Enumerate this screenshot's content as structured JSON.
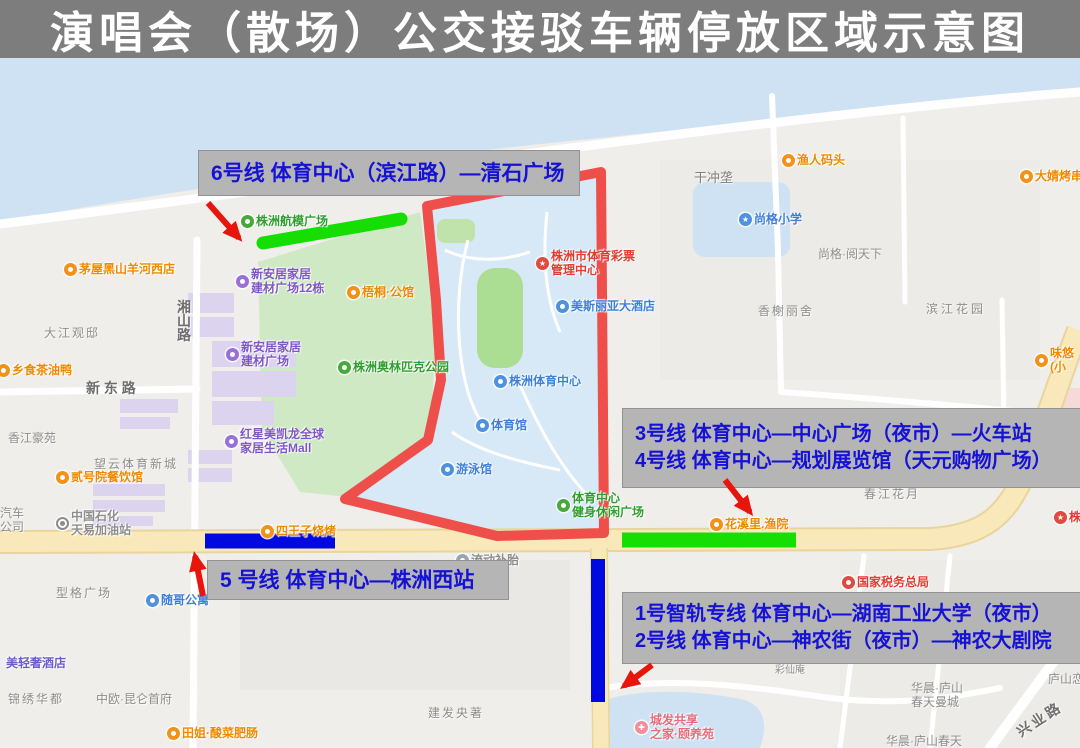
{
  "title": {
    "text": "演唱会（散场）公交接驳车辆停放区域示意图"
  },
  "colors": {
    "title_bg": "#7d7d7d",
    "title_text": "#ffffff",
    "annotation_box": "#b5b5b5",
    "annotation_text": "#1512d6",
    "route_green": "#16dd02",
    "route_blue": "#0009e0",
    "outline_red": "#ee4f4a",
    "arrow_red": "#e8150d"
  },
  "annotations": {
    "line6": {
      "text": "6号线 体育中心（滨江路）—清石广场"
    },
    "line34": {
      "line1": "3号线 体育中心—中心广场（夜市）—火车站",
      "line2": "4号线 体育中心—规划展览馆（天元购物广场）"
    },
    "line5": {
      "text": "5 号线 体育中心—株洲西站"
    },
    "line12": {
      "line1": "1号智轨专线 体育中心—湖南工业大学（夜市）",
      "line2": "2号线 体育中心—神农街（夜市）—神农大剧院"
    }
  },
  "map": {
    "pois": [
      {
        "name": "poi-yuren-wharf",
        "x": 788,
        "y": 160,
        "icon": "food-icon",
        "icon_bg": "#f39119",
        "text_color": "#ef8a00",
        "lines": [
          "渔人码头"
        ]
      },
      {
        "name": "poi-dajing-bbq",
        "x": 1026,
        "y": 176,
        "icon": "food-icon",
        "icon_bg": "#f39119",
        "text_color": "#ef8a00",
        "lines": [
          "大婧烤串"
        ]
      },
      {
        "name": "poi-shangge-school",
        "x": 745,
        "y": 219,
        "icon": "school-icon",
        "icon_bg": "#4e92dd",
        "glyph": "★",
        "text_color": "#3f7fd8",
        "lines": [
          "尚格小学"
        ]
      },
      {
        "name": "poi-weiyou-snack",
        "x": 1041,
        "y": 360,
        "icon": "food-icon",
        "icon_bg": "#f39119",
        "text_color": "#ef8a00",
        "lines": [
          "味悠",
          "(小"
        ]
      },
      {
        "name": "poi-maowu-restaurant",
        "x": 70,
        "y": 269,
        "icon": "food-icon",
        "icon_bg": "#f39119",
        "text_color": "#ef8a00",
        "lines": [
          "茅屋黑山羊河西店"
        ]
      },
      {
        "name": "poi-xiangshi-duck",
        "x": 3,
        "y": 370,
        "icon": "food-icon",
        "icon_bg": "#f39119",
        "text_color": "#ef8a00",
        "lines": [
          "乡食茶油鸭"
        ]
      },
      {
        "name": "poi-hangmo-square",
        "x": 247,
        "y": 221,
        "icon": "park-icon",
        "icon_bg": "#47a93c",
        "text_color": "#2f9e2f",
        "lines": [
          "株洲航模广场"
        ]
      },
      {
        "name": "poi-xinanju-12",
        "x": 242,
        "y": 281,
        "icon": "shop-icon",
        "icon_bg": "#9a70d8",
        "text_color": "#7e57c5",
        "lines": [
          "新安居家居",
          "建材广场12栋"
        ]
      },
      {
        "name": "poi-wutong-mansion",
        "x": 353,
        "y": 292,
        "icon": "food-icon",
        "icon_bg": "#f39119",
        "text_color": "#ef8a00",
        "lines": [
          "梧桐·公馆"
        ]
      },
      {
        "name": "poi-xinanju",
        "x": 232,
        "y": 354,
        "icon": "shop-icon",
        "icon_bg": "#9a70d8",
        "text_color": "#7e57c5",
        "lines": [
          "新安居家居",
          "建材广场"
        ]
      },
      {
        "name": "poi-olympic-park",
        "x": 344,
        "y": 367,
        "icon": "park-icon",
        "icon_bg": "#47a93c",
        "text_color": "#2f9e2f",
        "lines": [
          "株洲奥林匹克公园"
        ]
      },
      {
        "name": "poi-hongxing-mall",
        "x": 231,
        "y": 441,
        "icon": "shop-icon",
        "icon_bg": "#9a70d8",
        "text_color": "#7e57c5",
        "lines": [
          "红星美凯龙全球",
          "家居生活Mall"
        ]
      },
      {
        "name": "poi-sports-lottery",
        "x": 542,
        "y": 263,
        "icon": "star-icon",
        "icon_bg": "#e04a3f",
        "glyph": "★",
        "text_color": "#e03c31",
        "lines": [
          "株洲市体育彩票",
          "管理中心"
        ]
      },
      {
        "name": "poi-meisiliya-hotel",
        "x": 562,
        "y": 306,
        "icon": "hotel-icon",
        "icon_bg": "#4e92dd",
        "text_color": "#3f7fd8",
        "lines": [
          "美斯丽亚大酒店"
        ]
      },
      {
        "name": "poi-sports-center",
        "x": 500,
        "y": 381,
        "icon": "stadium-icon",
        "icon_bg": "#4e92dd",
        "text_color": "#3f7fd8",
        "lines": [
          "株洲体育中心"
        ]
      },
      {
        "name": "poi-gymnasium",
        "x": 482,
        "y": 425,
        "icon": "stadium-icon",
        "icon_bg": "#4e92dd",
        "text_color": "#3f7fd8",
        "lines": [
          "体育馆"
        ]
      },
      {
        "name": "poi-natatorium",
        "x": 447,
        "y": 469,
        "icon": "swim-icon",
        "icon_bg": "#4e92dd",
        "text_color": "#3f7fd8",
        "lines": [
          "游泳馆"
        ]
      },
      {
        "name": "poi-fitness-plaza",
        "x": 563,
        "y": 505,
        "icon": "park-icon",
        "icon_bg": "#47a93c",
        "text_color": "#2f9e2f",
        "lines": [
          "体育中心",
          "健身休闲广场"
        ]
      },
      {
        "name": "poi-erhaoyuan-restaurant",
        "x": 62,
        "y": 477,
        "icon": "food-icon",
        "icon_bg": "#f39119",
        "text_color": "#ef8a00",
        "lines": [
          "贰号院餐饮馆"
        ]
      },
      {
        "name": "poi-sinopec-gas",
        "x": 62,
        "y": 523,
        "icon": "gas-icon",
        "icon_bg": "#ffffff",
        "ring": "#8c8c8c",
        "dot": "#8c8c8c",
        "text_color": "#8d8d8d",
        "lines": [
          "中国石化",
          "天易加油站"
        ]
      },
      {
        "name": "poi-suige-apartment",
        "x": 152,
        "y": 600,
        "icon": "home-icon",
        "icon_bg": "#4e92dd",
        "text_color": "#3f7fd8",
        "lines": [
          "随哥公寓"
        ]
      },
      {
        "name": "poi-qingshe-hotel",
        "x": 6,
        "y": 663,
        "icon": "none",
        "text_color": "#6a5ccd",
        "lines": [
          "美轻奢酒店"
        ]
      },
      {
        "name": "poi-tianjie-restaurant",
        "x": 173,
        "y": 733,
        "icon": "food-icon",
        "icon_bg": "#f39119",
        "text_color": "#ef8a00",
        "lines": [
          "田姐·酸菜肥肠"
        ]
      },
      {
        "name": "poi-siwangzi-bbq",
        "x": 267,
        "y": 531,
        "icon": "food-icon",
        "icon_bg": "#f39119",
        "text_color": "#ef8a00",
        "lines": [
          "四王子烧烤"
        ]
      },
      {
        "name": "poi-chengfa-care",
        "x": 641,
        "y": 727,
        "icon": "care-icon",
        "icon_bg": "#ef8f9b",
        "glyph": "✚",
        "text_color": "#e36d7d",
        "lines": [
          "城发共享",
          "之家·颐养苑"
        ]
      },
      {
        "name": "poi-huaxili",
        "x": 716,
        "y": 524,
        "icon": "food-icon",
        "icon_bg": "#f39119",
        "text_color": "#ef8a00",
        "lines": [
          "花溪里.渔院"
        ]
      },
      {
        "name": "poi-tax-bureau",
        "x": 848,
        "y": 582,
        "icon": "gov-icon",
        "icon_bg": "#e04a3f",
        "text_color": "#e03c31",
        "lines": [
          "国家税务总局"
        ]
      },
      {
        "name": "poi-zhuzhou-edge",
        "x": 1060,
        "y": 517,
        "icon": "star-icon",
        "icon_bg": "#e04a3f",
        "glyph": "★",
        "text_color": "#e03c31",
        "lines": [
          "株洲"
        ]
      },
      {
        "name": "poi-liudong-tire",
        "x": 462,
        "y": 560,
        "icon": "service-icon",
        "icon_bg": "#9aa5b1",
        "text_color": "#8d8d8d",
        "lines": [
          "流动补胎"
        ]
      }
    ],
    "area_labels": [
      {
        "name": "label-ganchonglong",
        "x": 694,
        "y": 171,
        "size": 13,
        "color": "#7e7e7e",
        "lines": [
          "干冲垄"
        ]
      },
      {
        "name": "label-shangge-yuetianxia",
        "x": 818,
        "y": 247,
        "lines": [
          "尚格·阅天下"
        ]
      },
      {
        "name": "label-xiangxie-lishe",
        "x": 758,
        "y": 304,
        "spacing": 2,
        "lines": [
          "香榭丽舍"
        ]
      },
      {
        "name": "label-binjiang-garden",
        "x": 926,
        "y": 302,
        "spacing": 3,
        "lines": [
          "滨江花园"
        ]
      },
      {
        "name": "label-dajiang-guandi",
        "x": 44,
        "y": 326,
        "spacing": 2,
        "lines": [
          "大江观邸"
        ]
      },
      {
        "name": "label-xiangjiang-haoyuan",
        "x": 8,
        "y": 431,
        "lines": [
          "香江豪苑"
        ]
      },
      {
        "name": "label-wangyun-sports-town",
        "x": 94,
        "y": 457,
        "spacing": 2,
        "lines": [
          "望云体育新城"
        ]
      },
      {
        "name": "label-qiche-gongsi",
        "x": 0,
        "y": 506,
        "lines": [
          "汽车",
          "公司"
        ]
      },
      {
        "name": "label-xingge-square",
        "x": 56,
        "y": 586,
        "spacing": 2,
        "lines": [
          "型格广场"
        ]
      },
      {
        "name": "label-jinxiu-huadu",
        "x": 8,
        "y": 692,
        "spacing": 2,
        "lines": [
          "锦绣华都"
        ]
      },
      {
        "name": "label-zhongou-kunlun",
        "x": 96,
        "y": 692,
        "lines": [
          "中欧·昆仑首府"
        ]
      },
      {
        "name": "label-jianfa-yangzhu",
        "x": 428,
        "y": 706,
        "spacing": 2,
        "lines": [
          "建发央著"
        ]
      },
      {
        "name": "label-chunjiang-huayue",
        "x": 864,
        "y": 487,
        "spacing": 2,
        "lines": [
          "春江花月"
        ]
      },
      {
        "name": "label-huachen-lushan-mancheng",
        "x": 911,
        "y": 681,
        "lines": [
          "华晨·庐山",
          "春天曼城"
        ]
      },
      {
        "name": "label-lushanlian",
        "x": 1048,
        "y": 672,
        "lines": [
          "庐山恋"
        ]
      },
      {
        "name": "label-huachen-lushan-chuntian",
        "x": 886,
        "y": 734,
        "lines": [
          "华晨·庐山春天"
        ]
      },
      {
        "name": "label-caixianan",
        "x": 775,
        "y": 664,
        "size": 10,
        "lines": [
          "彩仙庵"
        ]
      },
      {
        "name": "label-xiangshan-road",
        "x": 177,
        "y": 300,
        "size": 14,
        "color": "#6e6e6e",
        "bold": true,
        "lines": [
          "湘",
          "山",
          "路"
        ]
      },
      {
        "name": "label-xindong-road",
        "x": 86,
        "y": 381,
        "size": 14,
        "color": "#6e6e6e",
        "bold": true,
        "lines": [
          "新 东 路"
        ]
      },
      {
        "name": "label-xingye-road",
        "x": 1014,
        "y": 712,
        "size": 14,
        "color": "#6e6e6e",
        "bold": true,
        "rotate": -33,
        "spacing": 3,
        "lines": [
          "兴业路"
        ]
      }
    ]
  }
}
